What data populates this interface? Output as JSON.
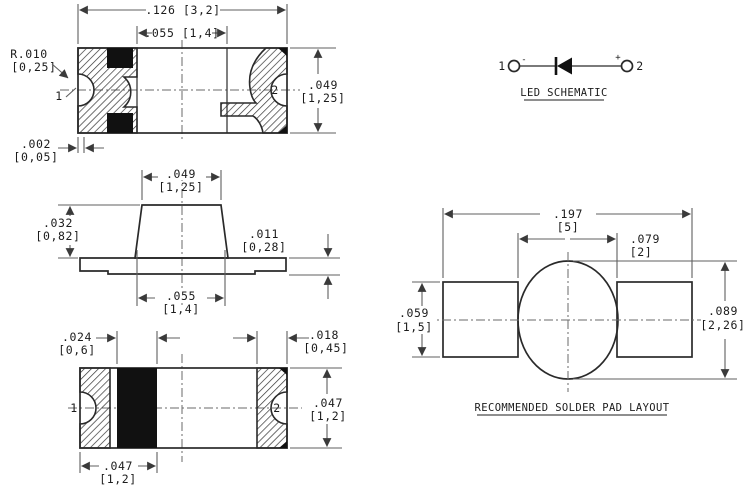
{
  "drawing": {
    "type": "SMD LED package dimensional drawing",
    "units_note": "inches [millimetres]"
  },
  "colors": {
    "line": "#2a2a2a",
    "dim_line": "#5f5f5f",
    "text": "#1c1c1c",
    "pin1": "#9c6b45",
    "pin2": "#49809f",
    "schematic_pin": "#3f3f3f",
    "fill_black": "#111111",
    "background": "#ffffff"
  },
  "top_view": {
    "dim_overall": ".126 [3,2]",
    "dim_inner": ".055 [1,4]",
    "dim_height_in": ".049",
    "dim_height_mm": "[1,25]",
    "dim_radius_in": "R.010",
    "dim_radius_mm": "[0,25]",
    "dim_offset_in": ".002",
    "dim_offset_mm": "[0,05]",
    "pin1": "1",
    "pin2": "2"
  },
  "side_view": {
    "dim_width_in": ".049",
    "dim_width_mm": "[1,25]",
    "dim_height_in": ".032",
    "dim_height_mm": "[0,82]",
    "dim_thickness_in": ".011",
    "dim_thickness_mm": "[0,28]",
    "dim_base_in": ".055",
    "dim_base_mm": "[1,4]"
  },
  "bottom_view": {
    "dim_band_in": ".024",
    "dim_band_mm": "[0,6]",
    "dim_terminal_in": ".018",
    "dim_terminal_mm": "[0,45]",
    "dim_height_in": ".047",
    "dim_height_mm": "[1,2]",
    "dim_width_in": ".047",
    "dim_width_mm": "[1,2]",
    "pin1": "1",
    "pin2": "2"
  },
  "schematic": {
    "title": "LED SCHEMATIC",
    "pin1": "1",
    "pin2": "2",
    "minus": "-",
    "plus": "+"
  },
  "pad_layout": {
    "title": "RECOMMENDED SOLDER PAD LAYOUT",
    "dim_overall_in": ".197",
    "dim_overall_mm": "[5]",
    "dim_gap_in": ".079",
    "dim_gap_mm": "[2]",
    "dim_pad_in": ".059",
    "dim_pad_mm": "[1,5]",
    "dim_circle_in": ".089",
    "dim_circle_mm": "[2,26]"
  }
}
